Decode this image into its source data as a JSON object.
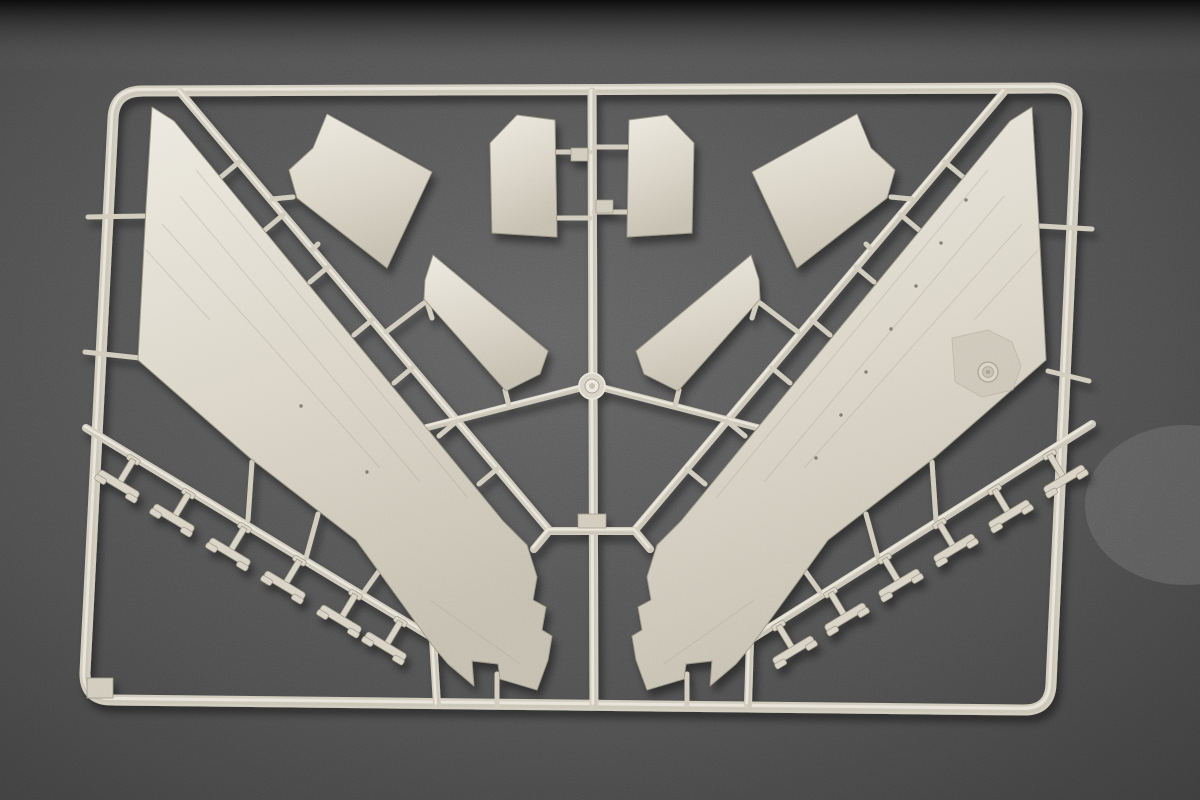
{
  "photo": {
    "subject": "plastic-model-kit-sprue-photograph",
    "canvas": {
      "width": 1200,
      "height": 800
    },
    "background": {
      "base_color": "#626262",
      "mid_color": "#4e4e4e",
      "corner_color": "#3c3c3c",
      "top_band_color": "#0c0c0c",
      "light_patch": {
        "cx": 1185,
        "cy": 505,
        "rx": 100,
        "ry": 80,
        "color": "#727272",
        "opacity": 0.45
      },
      "grain_opacity": 0.3
    },
    "plastic": {
      "light": "#ebe8de",
      "base": "#d7d2c4",
      "runner": "#cfcabb",
      "dark": "#c2bdae",
      "edge": "#97917f",
      "detail": "#a39d8d"
    },
    "sprue": {
      "frame": {
        "path": "M143,91 L1050,88 Q1078,87 1077,115 L1051,684 Q1050,711 1022,710 L112,700 Q84,700 85,672 L113,119 Q114,91 143,91 Z",
        "stroke_width": 11,
        "corner_tab": {
          "x": 87,
          "y": 678,
          "w": 26,
          "h": 20
        }
      },
      "runners": [
        {
          "name": "center-runner",
          "points": "592,92 594,705",
          "width": 9
        },
        {
          "name": "upper-left-runner",
          "points": "180,92 549,530",
          "width": 8
        },
        {
          "name": "upper-right-runner",
          "points": "1004,92 635,530",
          "width": 8
        },
        {
          "name": "center-bridge",
          "points": "534,549 549,531 635,531 650,549",
          "width": 8
        },
        {
          "name": "boss-arm-left",
          "points": "425,428 588,386",
          "width": 7
        },
        {
          "name": "boss-arm-right",
          "points": "759,428 596,386",
          "width": 7
        },
        {
          "name": "lower-left-runner",
          "points": "86,428 433,638 437,705",
          "width": 8
        },
        {
          "name": "lower-right-runner",
          "points": "1092,424 750,640 748,705",
          "width": 8
        }
      ],
      "gates": [
        "239,162 221,177",
        "283,215 265,230",
        "328,267 310,282",
        "372,320 354,335",
        "412,368 394,383",
        "457,421 439,436",
        "497,469 479,484",
        "945,162 963,177",
        "901,215 919,230",
        "856,267 874,282",
        "812,320 830,335",
        "772,368 790,383",
        "727,421 745,436",
        "687,469 705,484",
        "293,197 272,199",
        "318,244 312,250",
        "891,197 912,199",
        "866,244 872,250",
        "424,303 386,332",
        "760,303 798,332",
        "505,390 509,406",
        "679,390 675,406",
        "426,299 432,318",
        "758,299 752,318",
        "557,152 590,152",
        "557,218 590,218",
        "627,147 594,147",
        "627,212 594,212",
        "88,217 144,216",
        "85,352 140,358",
        "1092,229 1040,226",
        "1089,381 1048,371",
        "252,462 248,520",
        "318,514 306,558",
        "384,564 364,592",
        "932,462 936,520",
        "866,514 878,558",
        "800,564 820,592",
        "497,674 497,706",
        "687,674 687,706"
      ],
      "parts": [
        {
          "name": "wing-panel-left",
          "points": "152,107 174,121 503,521 527,545 537,577 533,600 546,607 542,630 552,636 548,660 537,690 500,679 498,664 472,661 474,686 448,664 432,645 356,540 250,458 138,360 146,208"
        },
        {
          "name": "wing-panel-right",
          "points": "1032,107 1010,121 681,521 657,545 647,577 651,600 638,607 642,630 632,636 636,660 647,690 684,679 686,664 712,661 710,686 736,664 752,645 828,540 934,458 1046,360 1038,208"
        },
        {
          "name": "spoiler-panel-left",
          "points": "327,114 432,172 387,268 297,198 289,170 313,148"
        },
        {
          "name": "spoiler-panel-right",
          "points": "857,114 752,172 797,268 887,198 895,170 871,148"
        },
        {
          "name": "flap-panel-left",
          "points": "433,255 548,351 540,374 506,391 424,299 425,280"
        },
        {
          "name": "flap-panel-right",
          "points": "751,255 636,351 644,374 678,391 760,299 759,280"
        },
        {
          "name": "intake-panel-left",
          "points": "490,143 517,115 555,120 557,237 492,233"
        },
        {
          "name": "intake-panel-right",
          "points": "694,143 667,115 629,120 627,237 692,233"
        }
      ],
      "struts": [
        {
          "x": 135,
          "y": 457,
          "r": 31
        },
        {
          "x": 190,
          "y": 491,
          "r": 31
        },
        {
          "x": 246,
          "y": 525,
          "r": 31
        },
        {
          "x": 301,
          "y": 558,
          "r": 31
        },
        {
          "x": 357,
          "y": 592,
          "r": 31
        },
        {
          "x": 402,
          "y": 619,
          "r": 31
        },
        {
          "x": 1048,
          "y": 452,
          "r": -31
        },
        {
          "x": 993,
          "y": 487,
          "r": -31
        },
        {
          "x": 938,
          "y": 521,
          "r": -31
        },
        {
          "x": 883,
          "y": 556,
          "r": -31
        },
        {
          "x": 829,
          "y": 590,
          "r": -31
        },
        {
          "x": 777,
          "y": 623,
          "r": -31
        }
      ],
      "details": {
        "injection_boss": {
          "cx": 592,
          "cy": 386,
          "r": 13,
          "ring_r": 7,
          "core_r": 3
        },
        "hinge_boss": {
          "cx": 988,
          "cy": 372,
          "r": 10,
          "ring_r": 5.5,
          "core_r": 2
        },
        "hinge_contour": "952,338 988,330 1012,342 1021,366 1013,390 982,397 955,382",
        "runner_tabs": [
          {
            "x": 571,
            "y": 148,
            "w": 17,
            "h": 13
          },
          {
            "x": 596,
            "y": 200,
            "w": 17,
            "h": 13
          },
          {
            "x": 578,
            "y": 514,
            "w": 28,
            "h": 14
          }
        ],
        "rivet_dots": [
          [
            966,
            200
          ],
          [
            941,
            243
          ],
          [
            916,
            286
          ],
          [
            891,
            329
          ],
          [
            866,
            372
          ],
          [
            841,
            415
          ],
          [
            816,
            458
          ],
          [
            367,
            472
          ],
          [
            301,
            406
          ]
        ],
        "panel_lines": [
          "196,170 468,498",
          "180,196 420,482",
          "162,224 380,468",
          "146,250 210,320",
          "430,600 520,664",
          "988,170 716,498",
          "1004,196 764,482",
          "1022,224 804,468",
          "1038,250 974,320",
          "754,600 664,664"
        ]
      }
    }
  }
}
